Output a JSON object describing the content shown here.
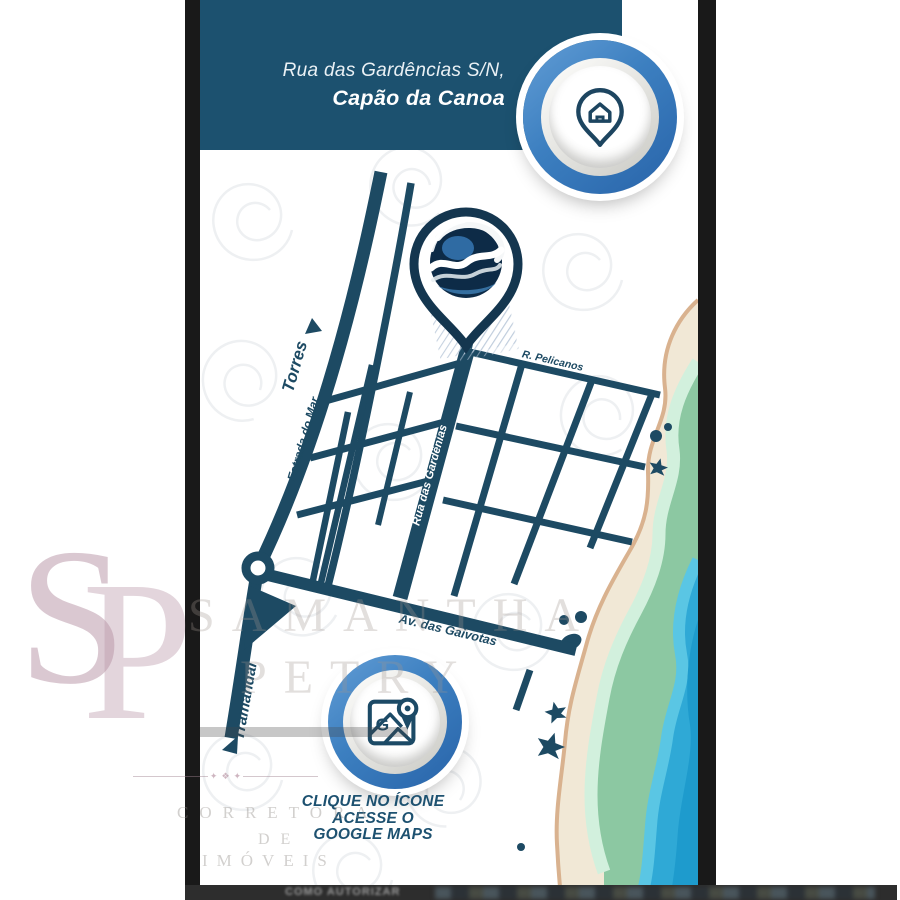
{
  "header": {
    "line1": "Rua das Gardências S/N,",
    "line2": "Capão da Canoa",
    "bg_color": "#1c516f"
  },
  "map": {
    "street_color": "#1d4a63",
    "labels": {
      "torres": "Torres",
      "estrada_do_mar": "Estrada do Mar",
      "tramandai": "Tramandaí",
      "pelicanos": "R. Pelicanos",
      "gardenias": "Rua das Gardênias",
      "gaivotas": "Av. das Gaivotas"
    },
    "beach_colors": {
      "sand": "#f1e8d6",
      "shoreline": "#d9b28f",
      "mint": "#d2f0dd",
      "green": "#8cc8a2",
      "wave_light": "#5ac6e4",
      "ocean": "#2fa9d6",
      "ocean_deep": "#1e9bcd"
    }
  },
  "buttons": {
    "home": {
      "icon": "house-location-pin",
      "ring_color": "#3c7fc0"
    },
    "maps": {
      "icon": "google-maps",
      "g_label": "G",
      "ring_color": "#3c7fc0"
    }
  },
  "cta": {
    "line1": "CLIQUE NO ÍCONE",
    "line2": "ACESSE O",
    "line3": "GOOGLE MAPS",
    "color": "#1d5170"
  },
  "watermark": {
    "monogram": [
      "S",
      "P"
    ],
    "name": [
      "SAMANTHA",
      "PETRY"
    ],
    "role": [
      "CORRETORA",
      "DE",
      "IMÓVEIS"
    ]
  },
  "bottom_strip": {
    "text": "COMO AUTORIZAR"
  }
}
